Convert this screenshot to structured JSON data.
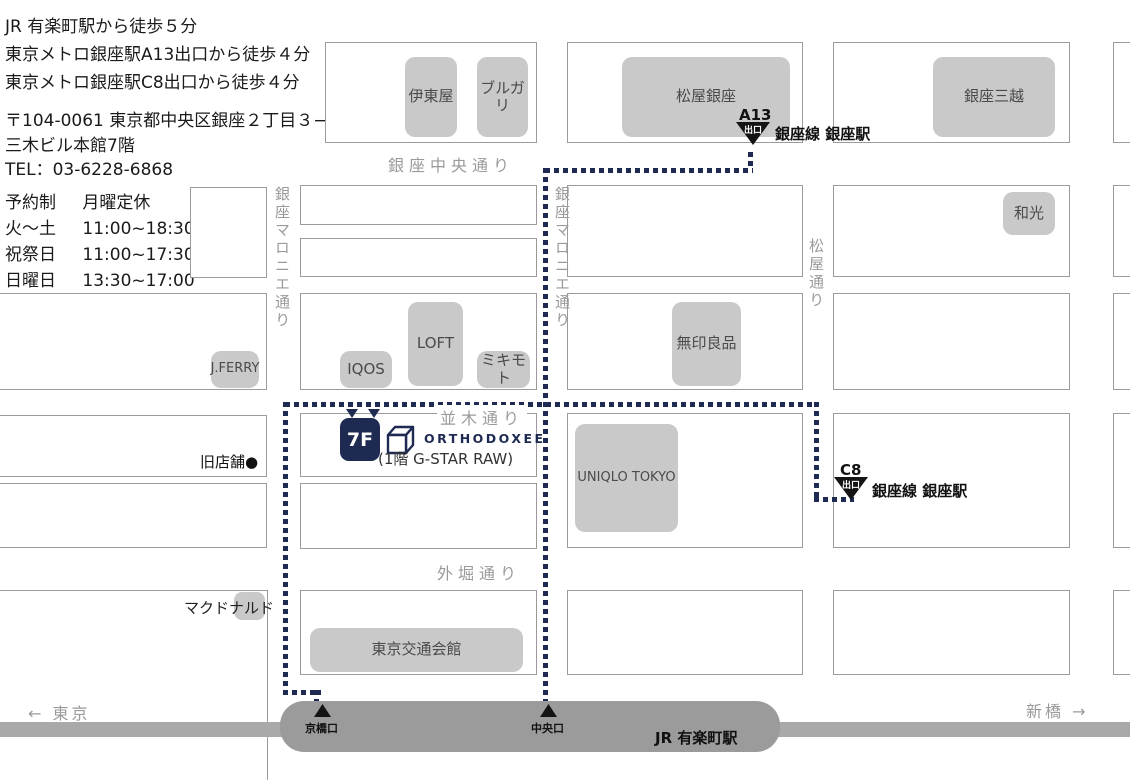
{
  "info": {
    "access_lines": [
      "JR 有楽町駅から徒歩５分",
      "東京メトロ銀座駅A13出口から徒歩４分",
      "東京メトロ銀座駅C8出口から徒歩４分"
    ],
    "address_lines": [
      "〒104-0061 東京都中央区銀座２丁目３−５",
      "三木ビル本館7階",
      "TEL：03-6228-6868"
    ],
    "hours": [
      {
        "label": "予約制",
        "value": "月曜定休"
      },
      {
        "label": "火～土",
        "value": "11:00~18:30"
      },
      {
        "label": "祝祭日",
        "value": "11:00~17:30"
      },
      {
        "label": "日曜日",
        "value": "13:30~17:00"
      }
    ]
  },
  "map": {
    "streets": {
      "chuo": "銀座中央通り",
      "maronie_left": "銀座マロニエ通り",
      "maronie_right": "銀座マロニエ通り",
      "matsuya": "松屋通り",
      "namiki": "並木通り",
      "sotobori": "外堀通り"
    },
    "buildings": [
      {
        "label": "伊東屋"
      },
      {
        "label": "ブルガリ"
      },
      {
        "label": "松屋銀座"
      },
      {
        "label": "銀座三越"
      },
      {
        "label": "和光"
      },
      {
        "label": "LOFT"
      },
      {
        "label": "IQOS"
      },
      {
        "label": "ミキモト"
      },
      {
        "label": "J.FERRY"
      },
      {
        "label": "無印良品"
      },
      {
        "label": "UNIQLO TOKYO"
      },
      {
        "label": "東京交通会館"
      }
    ],
    "exits": {
      "a13": {
        "code": "A13",
        "deguchi": "出口",
        "line": "銀座線 銀座駅"
      },
      "c8": {
        "code": "C8",
        "deguchi": "出口",
        "line": "銀座線 銀座駅"
      }
    },
    "store": {
      "floor": "7F",
      "name": "ORTHODOXEE",
      "note": "(1階 G-STAR RAW)",
      "former_site": "旧店舗●"
    },
    "landmarks": {
      "mcdonalds": "マクドナルド"
    },
    "jr": {
      "station": "JR 有楽町駅",
      "exit_kyobashi": "京橋口",
      "exit_chuo": "中央口"
    },
    "directions": {
      "west": "← 東京",
      "east": "新橋 →"
    },
    "colors": {
      "route_navy": "#1e2a52",
      "building_gray": "#c9c9c9",
      "block_border": "#9b9b9b",
      "street_text": "#9a9a9a",
      "jr_bar": "#9b9b9b"
    }
  }
}
